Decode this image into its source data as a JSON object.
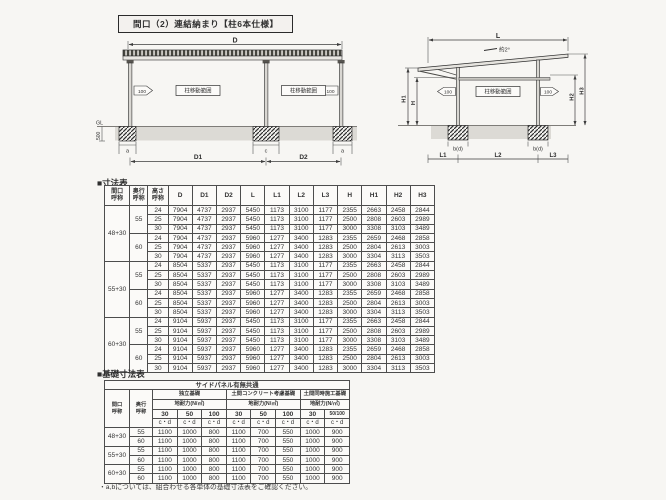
{
  "page": {
    "title": "間口（2）連結納まり【柱6本仕様】",
    "footnote": "・a,bについては、組合わせる各単体の基礎寸法表をご確認ください。"
  },
  "front_view": {
    "dim_d": "D",
    "offset_left": "100",
    "offset_right": "100",
    "range_left": "柱移動範囲",
    "range_right": "柱移動範囲",
    "gl": "GL",
    "depth_500": "500",
    "dim_a_left": "a",
    "dim_c": "c",
    "dim_a_right": "a",
    "dim_d1": "D1",
    "dim_d2": "D2"
  },
  "side_view": {
    "dim_l": "L",
    "slope": "約2°",
    "dim_h1": "H1",
    "dim_h": "H",
    "dim_h2": "H2",
    "dim_h3": "H3",
    "offset_left": "100",
    "offset_right": "100",
    "range": "柱移動範囲",
    "footing_left": "b(d)",
    "footing_right": "b(d)",
    "dim_l1": "L1",
    "dim_l2": "L2",
    "dim_l3": "L3"
  },
  "dim_table": {
    "title": "■寸法表",
    "col_headers": [
      "間口\n呼称",
      "奥行\n呼称",
      "高さ\n呼称",
      "D",
      "D1",
      "D2",
      "L",
      "L1",
      "L2",
      "L3",
      "H",
      "H1",
      "H2",
      "H3"
    ],
    "groups": [
      {
        "width_label": "48+30",
        "depths": [
          {
            "depth_label": "55",
            "rows": [
              {
                "h": "24",
                "v": [
                  "7904",
                  "4737",
                  "2937",
                  "5450",
                  "1173",
                  "3100",
                  "1177",
                  "2355",
                  "2663",
                  "2458",
                  "2844"
                ]
              },
              {
                "h": "25",
                "v": [
                  "7904",
                  "4737",
                  "2937",
                  "5450",
                  "1173",
                  "3100",
                  "1177",
                  "2500",
                  "2808",
                  "2603",
                  "2989"
                ]
              },
              {
                "h": "30",
                "v": [
                  "7904",
                  "4737",
                  "2937",
                  "5450",
                  "1173",
                  "3100",
                  "1177",
                  "3000",
                  "3308",
                  "3103",
                  "3489"
                ]
              }
            ]
          },
          {
            "depth_label": "60",
            "rows": [
              {
                "h": "24",
                "v": [
                  "7904",
                  "4737",
                  "2937",
                  "5960",
                  "1277",
                  "3400",
                  "1283",
                  "2355",
                  "2659",
                  "2468",
                  "2858"
                ]
              },
              {
                "h": "25",
                "v": [
                  "7904",
                  "4737",
                  "2937",
                  "5960",
                  "1277",
                  "3400",
                  "1283",
                  "2500",
                  "2804",
                  "2613",
                  "3003"
                ]
              },
              {
                "h": "30",
                "v": [
                  "7904",
                  "4737",
                  "2937",
                  "5960",
                  "1277",
                  "3400",
                  "1283",
                  "3000",
                  "3304",
                  "3113",
                  "3503"
                ]
              }
            ]
          }
        ]
      },
      {
        "width_label": "55+30",
        "depths": [
          {
            "depth_label": "55",
            "rows": [
              {
                "h": "24",
                "v": [
                  "8504",
                  "5337",
                  "2937",
                  "5450",
                  "1173",
                  "3100",
                  "1177",
                  "2355",
                  "2663",
                  "2458",
                  "2844"
                ]
              },
              {
                "h": "25",
                "v": [
                  "8504",
                  "5337",
                  "2937",
                  "5450",
                  "1173",
                  "3100",
                  "1177",
                  "2500",
                  "2808",
                  "2603",
                  "2989"
                ]
              },
              {
                "h": "30",
                "v": [
                  "8504",
                  "5337",
                  "2937",
                  "5450",
                  "1173",
                  "3100",
                  "1177",
                  "3000",
                  "3308",
                  "3103",
                  "3489"
                ]
              }
            ]
          },
          {
            "depth_label": "60",
            "rows": [
              {
                "h": "24",
                "v": [
                  "8504",
                  "5337",
                  "2937",
                  "5960",
                  "1277",
                  "3400",
                  "1283",
                  "2355",
                  "2659",
                  "2468",
                  "2858"
                ]
              },
              {
                "h": "25",
                "v": [
                  "8504",
                  "5337",
                  "2937",
                  "5960",
                  "1277",
                  "3400",
                  "1283",
                  "2500",
                  "2804",
                  "2613",
                  "3003"
                ]
              },
              {
                "h": "30",
                "v": [
                  "8504",
                  "5337",
                  "2937",
                  "5960",
                  "1277",
                  "3400",
                  "1283",
                  "3000",
                  "3304",
                  "3113",
                  "3503"
                ]
              }
            ]
          }
        ]
      },
      {
        "width_label": "60+30",
        "depths": [
          {
            "depth_label": "55",
            "rows": [
              {
                "h": "24",
                "v": [
                  "9104",
                  "5937",
                  "2937",
                  "5450",
                  "1173",
                  "3100",
                  "1177",
                  "2355",
                  "2663",
                  "2458",
                  "2844"
                ]
              },
              {
                "h": "25",
                "v": [
                  "9104",
                  "5937",
                  "2937",
                  "5450",
                  "1173",
                  "3100",
                  "1177",
                  "2500",
                  "2808",
                  "2603",
                  "2989"
                ]
              },
              {
                "h": "30",
                "v": [
                  "9104",
                  "5937",
                  "2937",
                  "5450",
                  "1173",
                  "3100",
                  "1177",
                  "3000",
                  "3308",
                  "3103",
                  "3489"
                ]
              }
            ]
          },
          {
            "depth_label": "60",
            "rows": [
              {
                "h": "24",
                "v": [
                  "9104",
                  "5937",
                  "2937",
                  "5960",
                  "1277",
                  "3400",
                  "1283",
                  "2355",
                  "2659",
                  "2468",
                  "2858"
                ]
              },
              {
                "h": "25",
                "v": [
                  "9104",
                  "5937",
                  "2937",
                  "5960",
                  "1277",
                  "3400",
                  "1283",
                  "2500",
                  "2804",
                  "2613",
                  "3003"
                ]
              },
              {
                "h": "30",
                "v": [
                  "9104",
                  "5937",
                  "2937",
                  "5960",
                  "1277",
                  "3400",
                  "1283",
                  "3000",
                  "3304",
                  "3113",
                  "3503"
                ]
              }
            ]
          }
        ]
      }
    ]
  },
  "foundation_table": {
    "title": "■基礎寸法表",
    "top_header": "サイドパネル有無共通",
    "col1": "間口\n呼称",
    "col2": "奥行\n呼称",
    "groups": [
      {
        "name": "独立基礎",
        "strength": "地耐力(N/㎡)",
        "cols": [
          "30",
          "50",
          "100"
        ]
      },
      {
        "name": "土間コンクリート考慮基礎",
        "strength": "地耐力(N/㎡)",
        "cols": [
          "30",
          "50",
          "100"
        ]
      },
      {
        "name": "土間同時施工基礎",
        "strength": "地耐力(N/㎡)",
        "cols": [
          "30",
          "50/100"
        ]
      }
    ],
    "cd": "c・d",
    "row_pairs": [
      {
        "width_label": "48+30",
        "rows": [
          {
            "depth": "55",
            "v": [
              "1100",
              "1000",
              "800",
              "1100",
              "700",
              "550",
              "1000",
              "900"
            ]
          },
          {
            "depth": "60",
            "v": [
              "1100",
              "1000",
              "800",
              "1100",
              "700",
              "550",
              "1000",
              "900"
            ]
          }
        ]
      },
      {
        "width_label": "55+30",
        "rows": [
          {
            "depth": "55",
            "v": [
              "1100",
              "1000",
              "800",
              "1100",
              "700",
              "550",
              "1000",
              "900"
            ]
          },
          {
            "depth": "60",
            "v": [
              "1100",
              "1000",
              "800",
              "1100",
              "700",
              "550",
              "1000",
              "900"
            ]
          }
        ]
      },
      {
        "width_label": "60+30",
        "rows": [
          {
            "depth": "55",
            "v": [
              "1100",
              "1000",
              "800",
              "1100",
              "700",
              "550",
              "1000",
              "900"
            ]
          },
          {
            "depth": "60",
            "v": [
              "1100",
              "1000",
              "800",
              "1100",
              "700",
              "550",
              "1000",
              "900"
            ]
          }
        ]
      }
    ]
  }
}
